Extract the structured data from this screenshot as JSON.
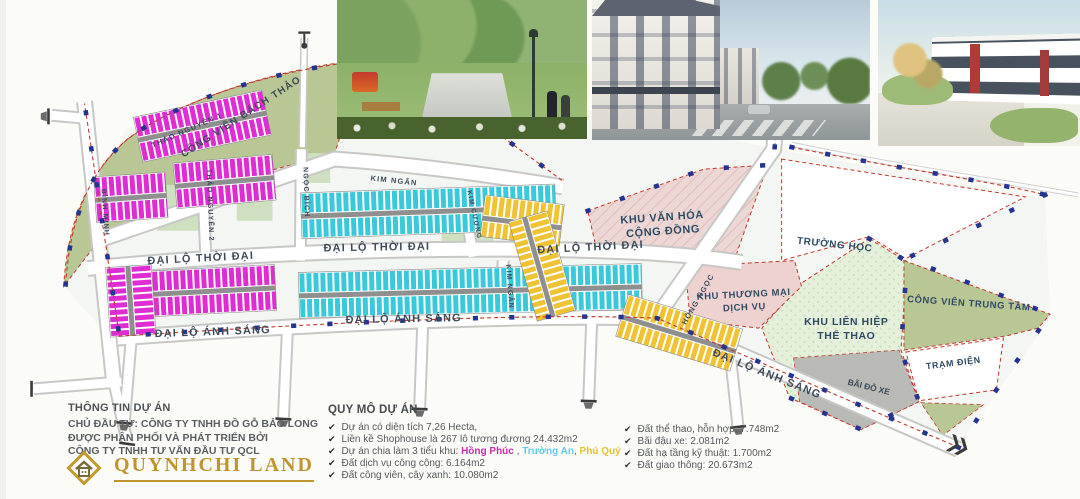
{
  "map": {
    "park_label": "CÔNG VIÊN BÁCH THẢO",
    "streets": {
      "thoi_dai": "ĐẠI LỘ THỜI ĐẠI",
      "anh_sang": "ĐẠI LỘ ÁNH SÁNG",
      "thao_nguyen_1": "THẢO NGUYÊN 1",
      "thao_nguyen_2": "THẢO NGUYÊN 2",
      "ngoc_bich": "NGỌC BÍCH",
      "binh_minh": "BÌNH MINH",
      "kim_ngan": "KIM NGÂN",
      "kim_cuong": "KIM CƯƠNG",
      "hong_ngoc": "HỒNG NGỌC"
    },
    "areas": {
      "van_hoa": [
        "KHU VĂN HÓA",
        "CỘNG ĐỒNG"
      ],
      "truong_hoc": "TRƯỜNG HỌC",
      "thuong_mai": [
        "KHU THƯƠNG MẠI",
        "DỊCH VỤ"
      ],
      "the_thao": [
        "KHU LIÊN HIỆP",
        "THỂ THAO"
      ],
      "trung_tam": "CÔNG VIÊN TRUNG TÂM",
      "tram_dien": "TRẠM ĐIỆN",
      "bai_do_xe": "BÃI ĐỖ XE"
    },
    "lot_colors": {
      "hong_phuc": "#df2cd3",
      "truong_an": "#39c9da",
      "phu_quy": "#f0c335"
    }
  },
  "bottom": {
    "check": "✔",
    "info": {
      "title": "THÔNG TIN DỰ ÁN",
      "line1": "CHỦ ĐẦU TƯ: CÔNG TY TNHH ĐỒ GỖ BẢO LONG",
      "line2": "ĐƯỢC PHÂN PHỐI VÀ PHÁT TRIỂN BỞI",
      "line3": "CÔNG TY TNHH TƯ VẤN ĐẦU TƯ QCL"
    },
    "logo_text": "QUYNHCHI LAND",
    "scale": {
      "title": "QUY MÔ DỰ ÁN",
      "i1": "Dự án có diện tích 7,26 Hecta,",
      "i2": "Liền kề Shophouse là 267 lô tương đương 24.432m2",
      "i3_prefix": "Dự án chia làm 3 tiểu khu: ",
      "sep1": " , ",
      "sep2": ", ",
      "i4": "Đất dịch vụ công cộng: 6.164m2",
      "i5": "Đất công viên, cây xanh: 10.080m2"
    },
    "zones": {
      "hong_phuc": {
        "name": "Hồng Phúc",
        "color": "#c92fa6"
      },
      "truong_an": {
        "name": "Trường An",
        "color": "#63c9e8"
      },
      "phu_quy": {
        "name": "Phú Quý",
        "color": "#e5c32f"
      }
    },
    "right": {
      "i1": "Đất thể thao, hỗn hợp: 7.748m2",
      "i2": "Bãi đậu xe: 2.081m2",
      "i3": "Đất hạ tầng kỹ thuật: 1.700m2",
      "i4": "Đất giao thông: 20.673m2"
    }
  }
}
